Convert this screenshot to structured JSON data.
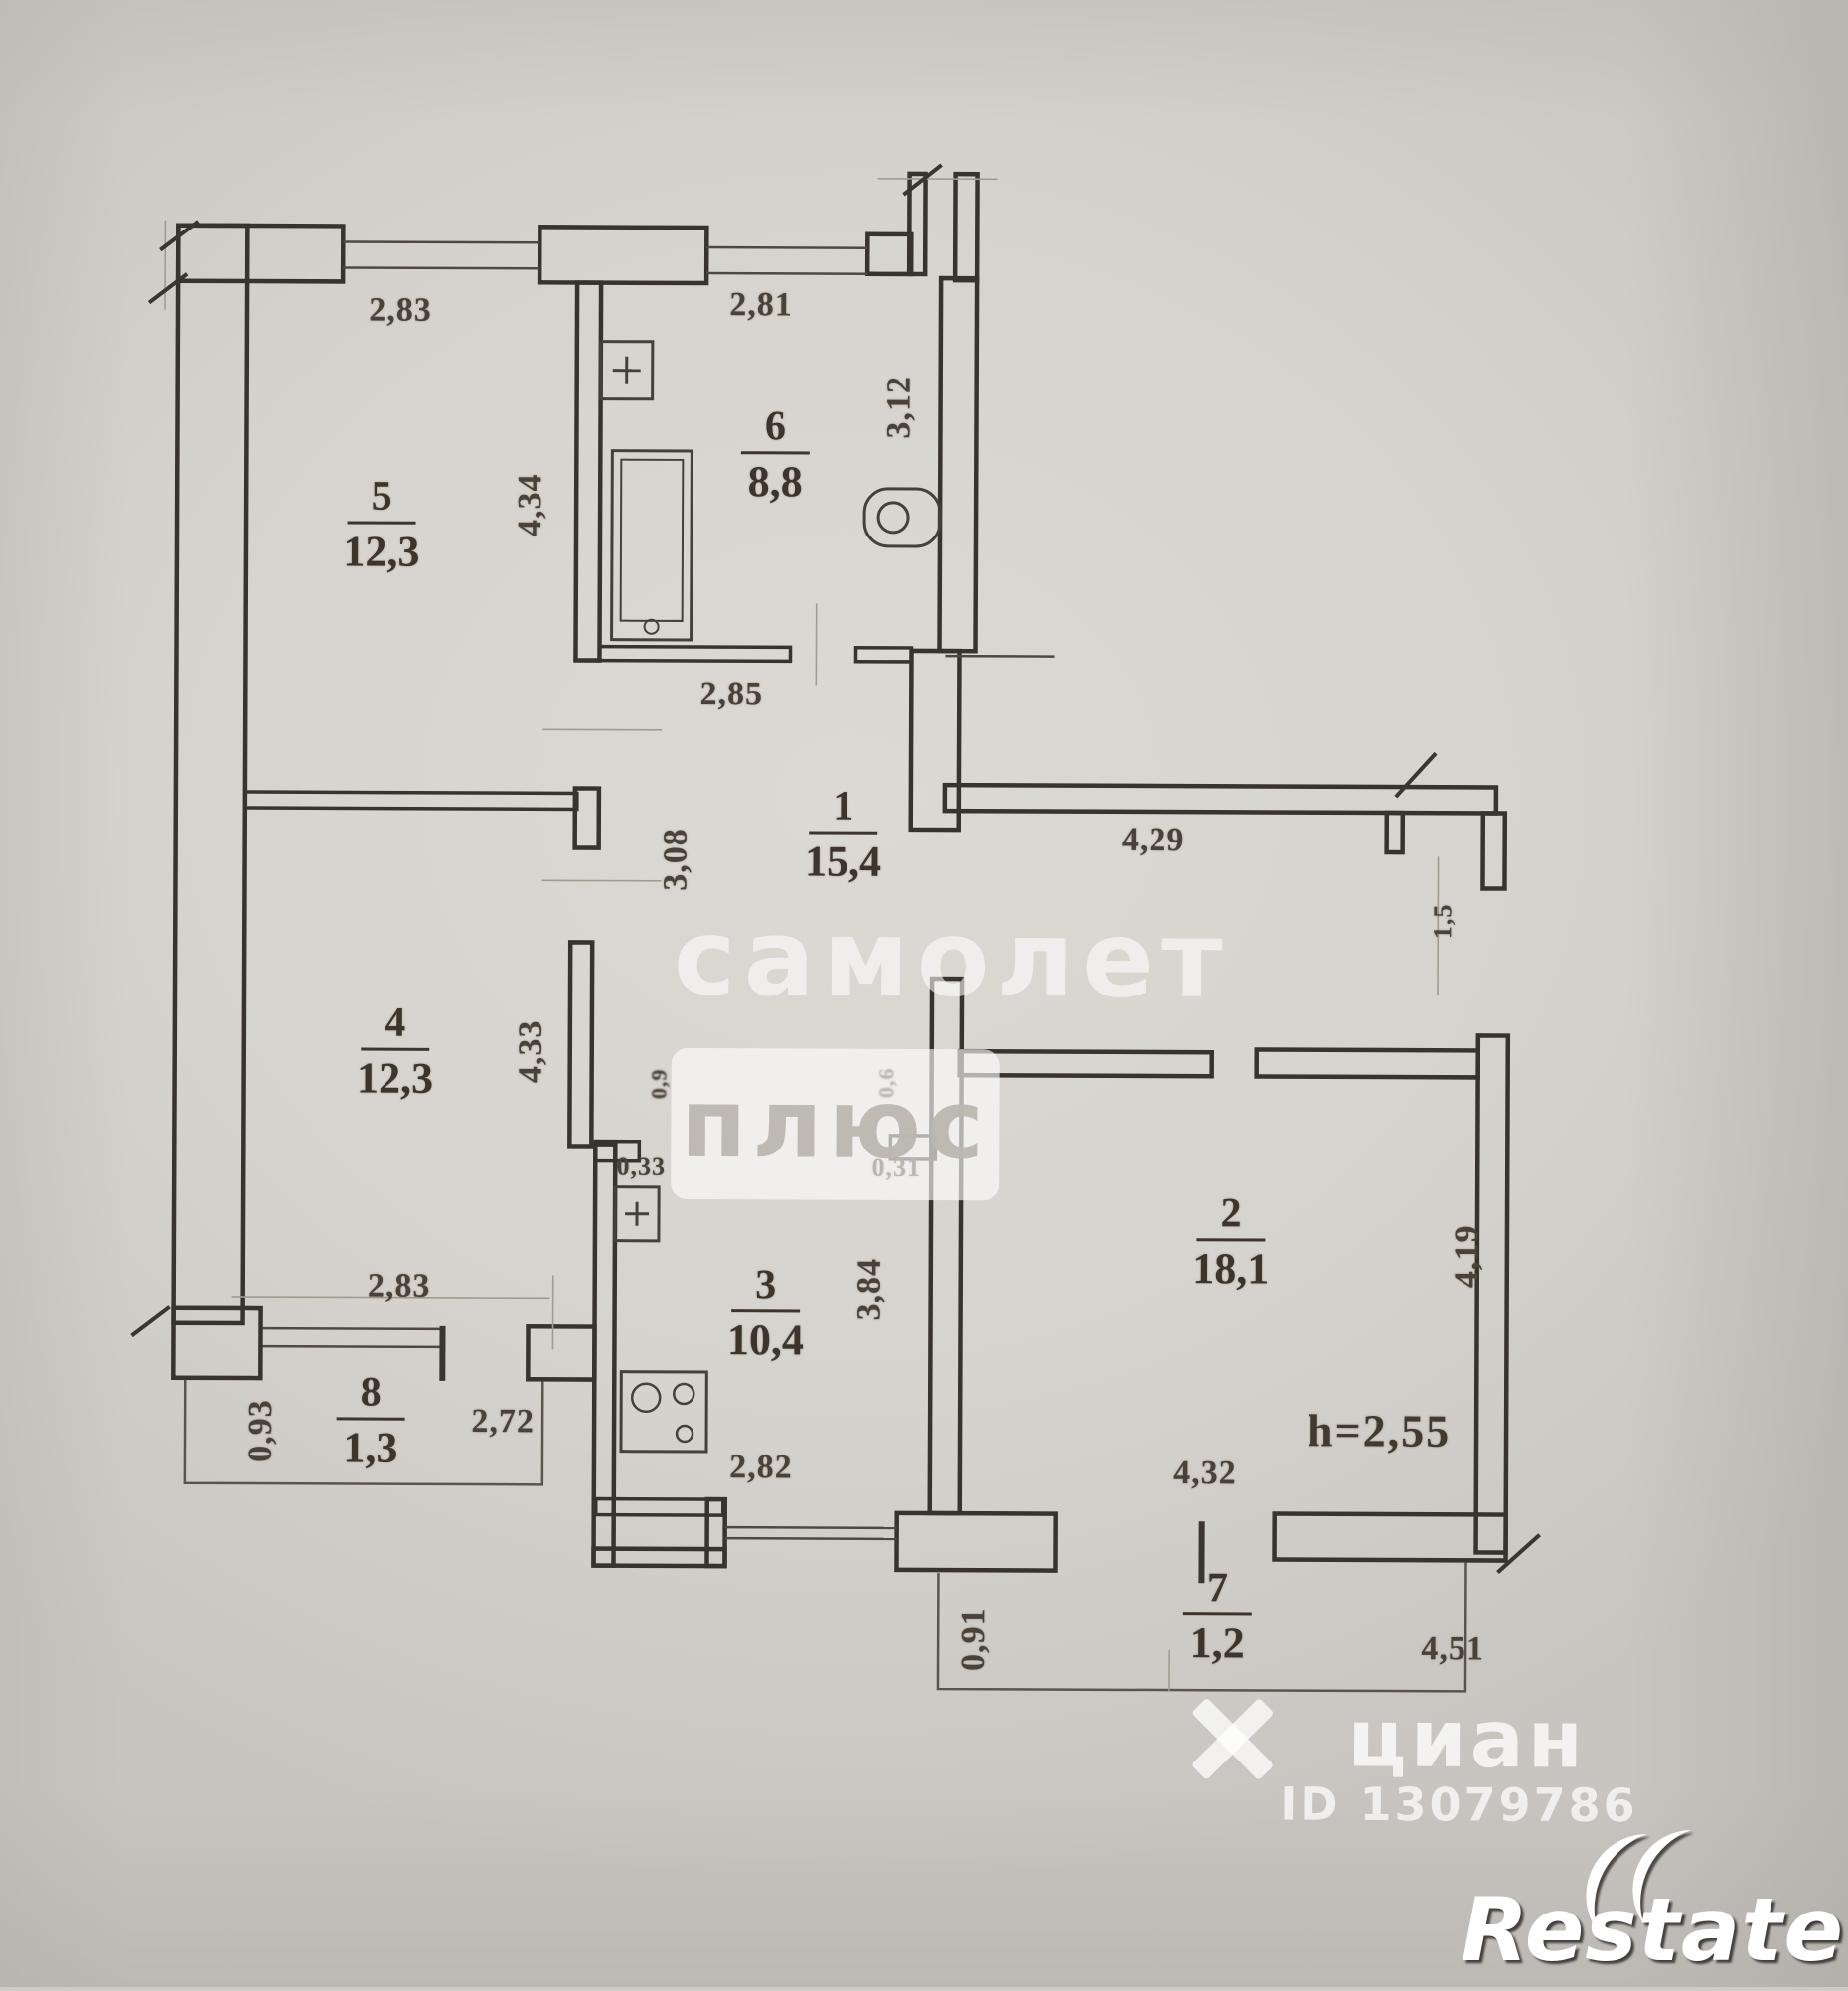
{
  "plan": {
    "rooms": [
      {
        "number": "5",
        "area": "12,3"
      },
      {
        "number": "6",
        "area": "8,8"
      },
      {
        "number": "1",
        "area": "15,4"
      },
      {
        "number": "4",
        "area": "12,3"
      },
      {
        "number": "2",
        "area": "18,1"
      },
      {
        "number": "3",
        "area": "10,4"
      },
      {
        "number": "8",
        "area": "1,3"
      },
      {
        "number": "7",
        "area": "1,2"
      }
    ],
    "dims": {
      "room5_top": "2,83",
      "room6_top": "2,81",
      "room6_side": "3,12",
      "room5_side": "4,34",
      "bath_bottom": "2,85",
      "hallway_top": "4,29",
      "corridor_side": "3,08",
      "room4_side": "4,33",
      "room4_bottom": "2,83",
      "kitchen_stub_left": "0,33",
      "kitchen_stub_right": "0,31",
      "kitchen_side": "3,84",
      "kitchen_bottom": "2,82",
      "room2_side": "4,19",
      "room2_bottom": "4,32",
      "balcony8_side": "0,93",
      "balcony8_bottom": "2,72",
      "balcony7_side": "0,91",
      "balcony7_bottom": "4,51",
      "right_opening": "1,5",
      "niche_left": "0,9",
      "niche_right": "0,6",
      "ceiling_height": "h=2,55"
    }
  },
  "watermarks": {
    "samolet": "самолет",
    "plus": "плюс",
    "cian": "циан",
    "cian_id": "ID 13079786",
    "restate": "Restate"
  }
}
